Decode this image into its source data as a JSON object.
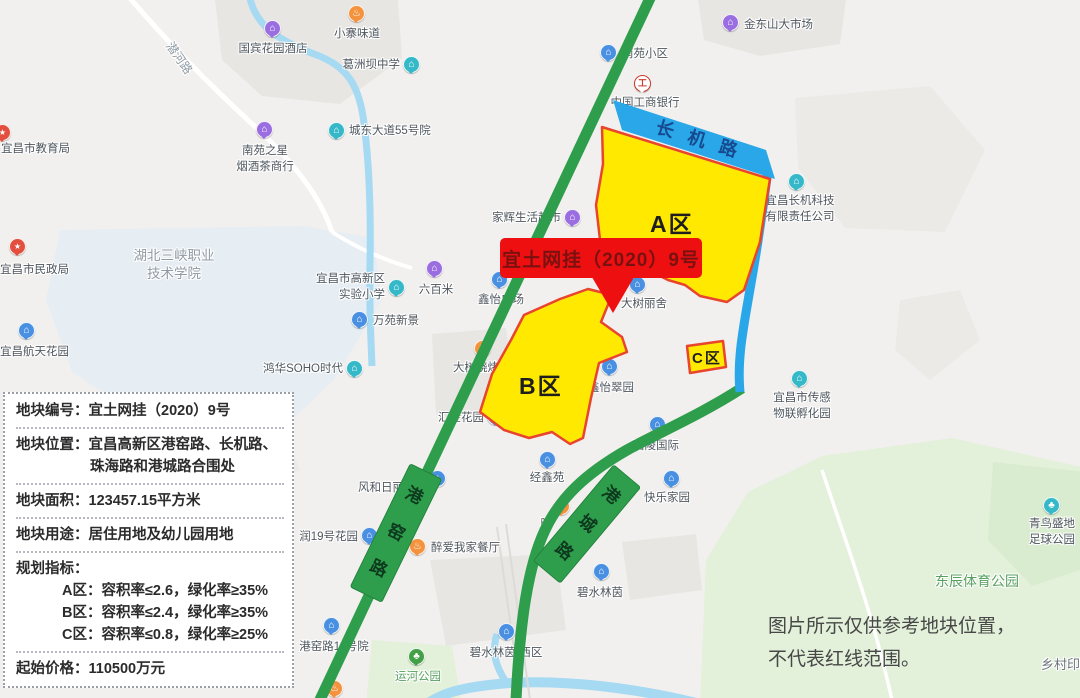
{
  "palette": {
    "map_bg": "#f2f0ee",
    "parcel_fill": "#ffe900",
    "parcel_border": "#e8442e",
    "road_green": "#2f9e4c",
    "badge_green": "#2f9e4c",
    "badge_text": "#0d3a1e",
    "road_blue": "#29a7e8",
    "road_blue_text": "#17498f",
    "callout_bg": "#ee1010",
    "callout_text": "#7a1111",
    "river": "#a6d9f2",
    "park": "#e3f0da",
    "campus": "#e6edf3",
    "building": "#e8e6e3",
    "pin_blue": "#4a90e2",
    "pin_purple": "#9a6ee0",
    "pin_teal": "#35b8c8",
    "pin_orange": "#f5923e",
    "pin_red": "#e34f3f",
    "pin_green": "#43a047",
    "label_text": "#4e565e",
    "area_green_text": "#57a05f",
    "area_gray_text": "#8e99a3",
    "disclaimer_text": "#474747",
    "info_text": "#2b2b2b"
  },
  "map": {
    "callout": {
      "label": "宜土网挂（2020）9号"
    },
    "parcels": [
      {
        "id": "A",
        "label": "A区"
      },
      {
        "id": "B",
        "label": "B区"
      },
      {
        "id": "C",
        "label": "C区"
      }
    ],
    "blue_road": {
      "label": "长机路"
    },
    "road_badges": [
      {
        "label": "港窑路",
        "x": 396,
        "y": 533,
        "w": 34,
        "h": 136,
        "rot": 26
      },
      {
        "label": "港城路",
        "x": 587,
        "y": 524,
        "w": 34,
        "h": 124,
        "rot": 40
      }
    ],
    "pois": [
      {
        "label": "国宾花园酒店",
        "x": 273,
        "y": 29,
        "color": "purple",
        "glyph": "home",
        "align": "center",
        "lx": 273,
        "ly": 42
      },
      {
        "label": "小寨味道",
        "x": 357,
        "y": 14,
        "color": "orange",
        "glyph": "food",
        "align": "center",
        "lx": 357,
        "ly": 27
      },
      {
        "label": "葛洲坝中学",
        "x": 412,
        "y": 65,
        "color": "teal",
        "glyph": "home",
        "align": "right",
        "lx": 400,
        "ly": 58
      },
      {
        "label": "宜昌市教育局",
        "x": 3,
        "y": 133,
        "color": "red",
        "glyph": "star",
        "align": "left",
        "lx": 1,
        "ly": 142
      },
      {
        "lines": [
          "南苑之星",
          "烟酒茶商行"
        ],
        "x": 265,
        "y": 130,
        "color": "purple",
        "glyph": "home",
        "align": "center",
        "lx": 265,
        "ly": 144
      },
      {
        "label": "城东大道55号院",
        "x": 337,
        "y": 131,
        "color": "teal",
        "glyph": "home",
        "align": "left",
        "lx": 349,
        "ly": 124
      },
      {
        "label": "宜昌市民政局",
        "x": 18,
        "y": 247,
        "color": "red",
        "glyph": "star",
        "align": "left",
        "lx": 0,
        "ly": 263
      },
      {
        "label": "宜昌航天花园",
        "x": 27,
        "y": 331,
        "color": "blue",
        "glyph": "home",
        "align": "left",
        "lx": 0,
        "ly": 345
      },
      {
        "lines": [
          "宜昌市高新区",
          "实验小学"
        ],
        "x": 397,
        "y": 288,
        "color": "teal",
        "glyph": "home",
        "align": "right",
        "lx": 385,
        "ly": 272
      },
      {
        "label": "六百米",
        "x": 435,
        "y": 269,
        "color": "purple",
        "glyph": "home",
        "align": "center",
        "lx": 436,
        "ly": 283
      },
      {
        "label": "万苑新景",
        "x": 360,
        "y": 320,
        "color": "blue",
        "glyph": "home",
        "align": "left",
        "lx": 373,
        "ly": 314
      },
      {
        "label": "鸿华SOHO时代",
        "x": 355,
        "y": 369,
        "color": "teal",
        "glyph": "home",
        "align": "right",
        "lx": 343,
        "ly": 362
      },
      {
        "label": "南苑小区",
        "x": 609,
        "y": 53,
        "color": "blue",
        "glyph": "home",
        "align": "left",
        "lx": 622,
        "ly": 47
      },
      {
        "label": "中国工商银行",
        "x": 643,
        "y": 84,
        "color": "bank",
        "glyph": "bank",
        "align": "center",
        "lx": 645,
        "ly": 96
      },
      {
        "label": "金东山大市场",
        "x": 731,
        "y": 23,
        "color": "purple",
        "glyph": "home",
        "align": "left",
        "lx": 744,
        "ly": 18
      },
      {
        "label": "家辉生活超市",
        "x": 573,
        "y": 218,
        "color": "purple",
        "glyph": "home",
        "align": "right",
        "lx": 561,
        "ly": 211
      },
      {
        "label": "鑫怡广场",
        "x": 500,
        "y": 280,
        "color": "blue",
        "glyph": "home",
        "align": "center",
        "lx": 501,
        "ly": 293
      },
      {
        "label": "大树丽舍",
        "x": 638,
        "y": 285,
        "color": "blue",
        "glyph": "home",
        "align": "center",
        "lx": 644,
        "ly": 297
      },
      {
        "lines": [
          "宜昌长机科技",
          "有限责任公司"
        ],
        "x": 797,
        "y": 182,
        "color": "teal",
        "glyph": "home",
        "align": "center",
        "lx": 800,
        "ly": 194
      },
      {
        "label": "大树烧烤",
        "x": 483,
        "y": 349,
        "color": "orange",
        "glyph": "food",
        "align": "right",
        "lx": 499,
        "ly": 361
      },
      {
        "label": "鑫怡翠园",
        "x": 610,
        "y": 367,
        "color": "blue",
        "glyph": "home",
        "align": "center",
        "lx": 611,
        "ly": 381
      },
      {
        "label": "汇金花园",
        "x": 496,
        "y": 417,
        "color": "blue",
        "glyph": "home",
        "align": "right",
        "lx": 484,
        "ly": 411
      },
      {
        "label": "西陵国际",
        "x": 658,
        "y": 425,
        "color": "blue",
        "glyph": "home",
        "align": "center",
        "lx": 656,
        "ly": 439
      },
      {
        "label": "经鑫苑",
        "x": 548,
        "y": 460,
        "color": "blue",
        "glyph": "home",
        "align": "center",
        "lx": 547,
        "ly": 471
      },
      {
        "label": "快乐家园",
        "x": 672,
        "y": 479,
        "color": "blue",
        "glyph": "home",
        "align": "center",
        "lx": 667,
        "ly": 491
      },
      {
        "label": "风和日丽",
        "x": 438,
        "y": 479,
        "color": "blue",
        "glyph": "home",
        "align": "right",
        "lx": 404,
        "ly": 481
      },
      {
        "label": "润19号花园",
        "x": 370,
        "y": 536,
        "color": "blue",
        "glyph": "home",
        "align": "right",
        "lx": 358,
        "ly": 530
      },
      {
        "label": "醉爱我家餐厅",
        "x": 418,
        "y": 547,
        "color": "orange",
        "glyph": "food",
        "align": "left",
        "lx": 431,
        "ly": 541
      },
      {
        "label": "晗",
        "x": 562,
        "y": 507,
        "color": "orange",
        "glyph": "food",
        "align": "right",
        "lx": 552,
        "ly": 517
      },
      {
        "label": "碧水林茵",
        "x": 602,
        "y": 572,
        "color": "blue",
        "glyph": "home",
        "align": "center",
        "lx": 600,
        "ly": 586
      },
      {
        "label": "港窑路11号院",
        "x": 332,
        "y": 626,
        "color": "blue",
        "glyph": "home",
        "align": "center",
        "lx": 334,
        "ly": 640
      },
      {
        "label": "碧水林茵-西区",
        "x": 507,
        "y": 632,
        "color": "blue",
        "glyph": "home",
        "align": "center",
        "lx": 506,
        "ly": 646
      },
      {
        "label": "运河公园",
        "x": 417,
        "y": 657,
        "color": "green",
        "glyph": "park",
        "align": "center",
        "lx": 418,
        "ly": 670,
        "label_class": "green"
      },
      {
        "lines": [
          "宜昌市传感",
          "物联孵化园"
        ],
        "x": 800,
        "y": 379,
        "color": "teal",
        "glyph": "home",
        "align": "center",
        "lx": 802,
        "ly": 391
      },
      {
        "lines": [
          "青鸟盛地",
          "足球公园"
        ],
        "x": 1052,
        "y": 506,
        "color": "teal",
        "glyph": "park",
        "align": "center",
        "lx": 1052,
        "ly": 517
      },
      {
        "x": 335,
        "y": 689,
        "color": "orange",
        "glyph": "food"
      }
    ],
    "area_labels": [
      {
        "label": "潜河路",
        "x": 179,
        "y": 50,
        "rotate": 55,
        "cls": "gray",
        "size": 12,
        "align": "center"
      },
      {
        "lines": [
          "湖北三峡职业",
          "技术学院"
        ],
        "x": 174,
        "y": 247,
        "cls": "gray",
        "size": 13.5,
        "align": "center"
      },
      {
        "label": "东辰体育公园",
        "x": 977,
        "y": 572,
        "cls": "green",
        "size": 14,
        "align": "center"
      },
      {
        "label": "乡村印象",
        "x": 1041,
        "y": 656,
        "cls": "dark",
        "size": 13,
        "align": "left"
      }
    ]
  },
  "info_panel": {
    "rows": [
      {
        "label": "地块编号：",
        "value": "宜土网挂（2020）9号"
      },
      {
        "label": "地块位置：",
        "value": "宜昌高新区港窑路、长机路、",
        "value_lines": [
          "珠海路和港城路合围处"
        ]
      },
      {
        "label": "地块面积：",
        "value": "123457.15平方米"
      },
      {
        "label": "地块用途：",
        "value": "居住用地及幼儿园用地"
      },
      {
        "label": "规划指标：",
        "value": "",
        "sub_lines": [
          "A区：容积率≤2.6，绿化率≥35%",
          "B区：容积率≤2.4，绿化率≥35%",
          "C区：容积率≤0.8，绿化率≥25%"
        ]
      },
      {
        "label": "起始价格：",
        "value": "110500万元"
      }
    ]
  },
  "disclaimer": {
    "lines": [
      "图片所示仅供参考地块位置，",
      "不代表红线范围。"
    ]
  }
}
